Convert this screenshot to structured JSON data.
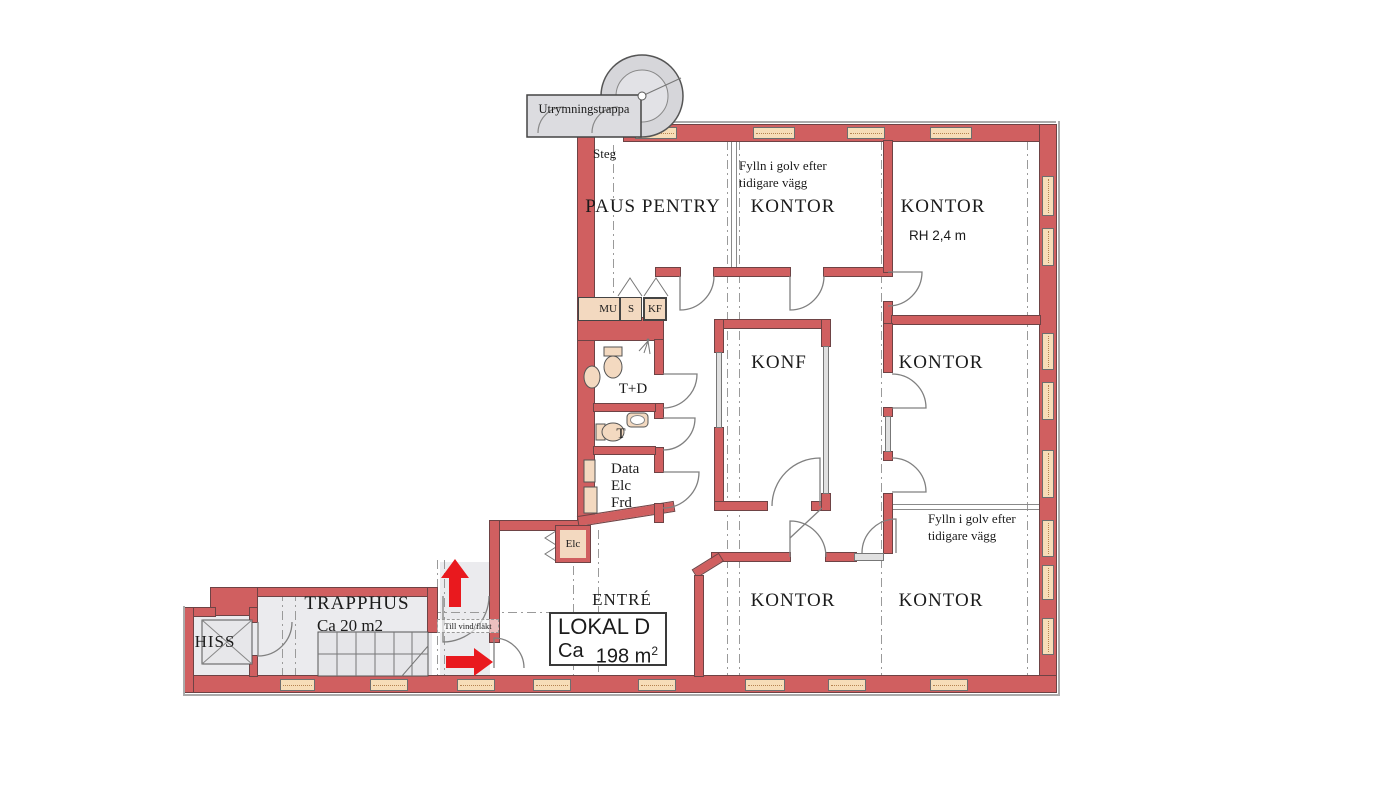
{
  "plan": {
    "escape_stair": "Utrymningstrappa",
    "steg": "Steg",
    "fylln_line1": "Fylln i golv efter",
    "fylln_line2": "tidigare vägg",
    "rooms": {
      "paus_pentry": "PAUS PENTRY",
      "kontor": "KONTOR",
      "rh_note": "RH 2,4 m",
      "konf": "KONF",
      "wc_dusch": "T+D",
      "wc": "T",
      "data_room": [
        "Data",
        "Elc",
        "Frd"
      ],
      "elc_closet": "Elc",
      "entre": "ENTRÉ",
      "trapphus": "TRAPPHUS",
      "trapphus_area": "Ca 20 m2",
      "hiss": "HISS",
      "till_vind": "Till vind/fläkt"
    },
    "pentry_units": [
      "MU",
      "S",
      "KF"
    ],
    "lokal": {
      "name": "LOKAL D",
      "area_prefix": "Ca",
      "area_value": "198 m",
      "area_exp": "2"
    }
  },
  "colors": {
    "wall": "#d05f60",
    "win": "#f7ddb8",
    "winline": "#b5824f",
    "floor": "#ebebee",
    "fixture": "#f3d9c0",
    "arrow": "#e9191e",
    "text": "#1b1b1b"
  }
}
